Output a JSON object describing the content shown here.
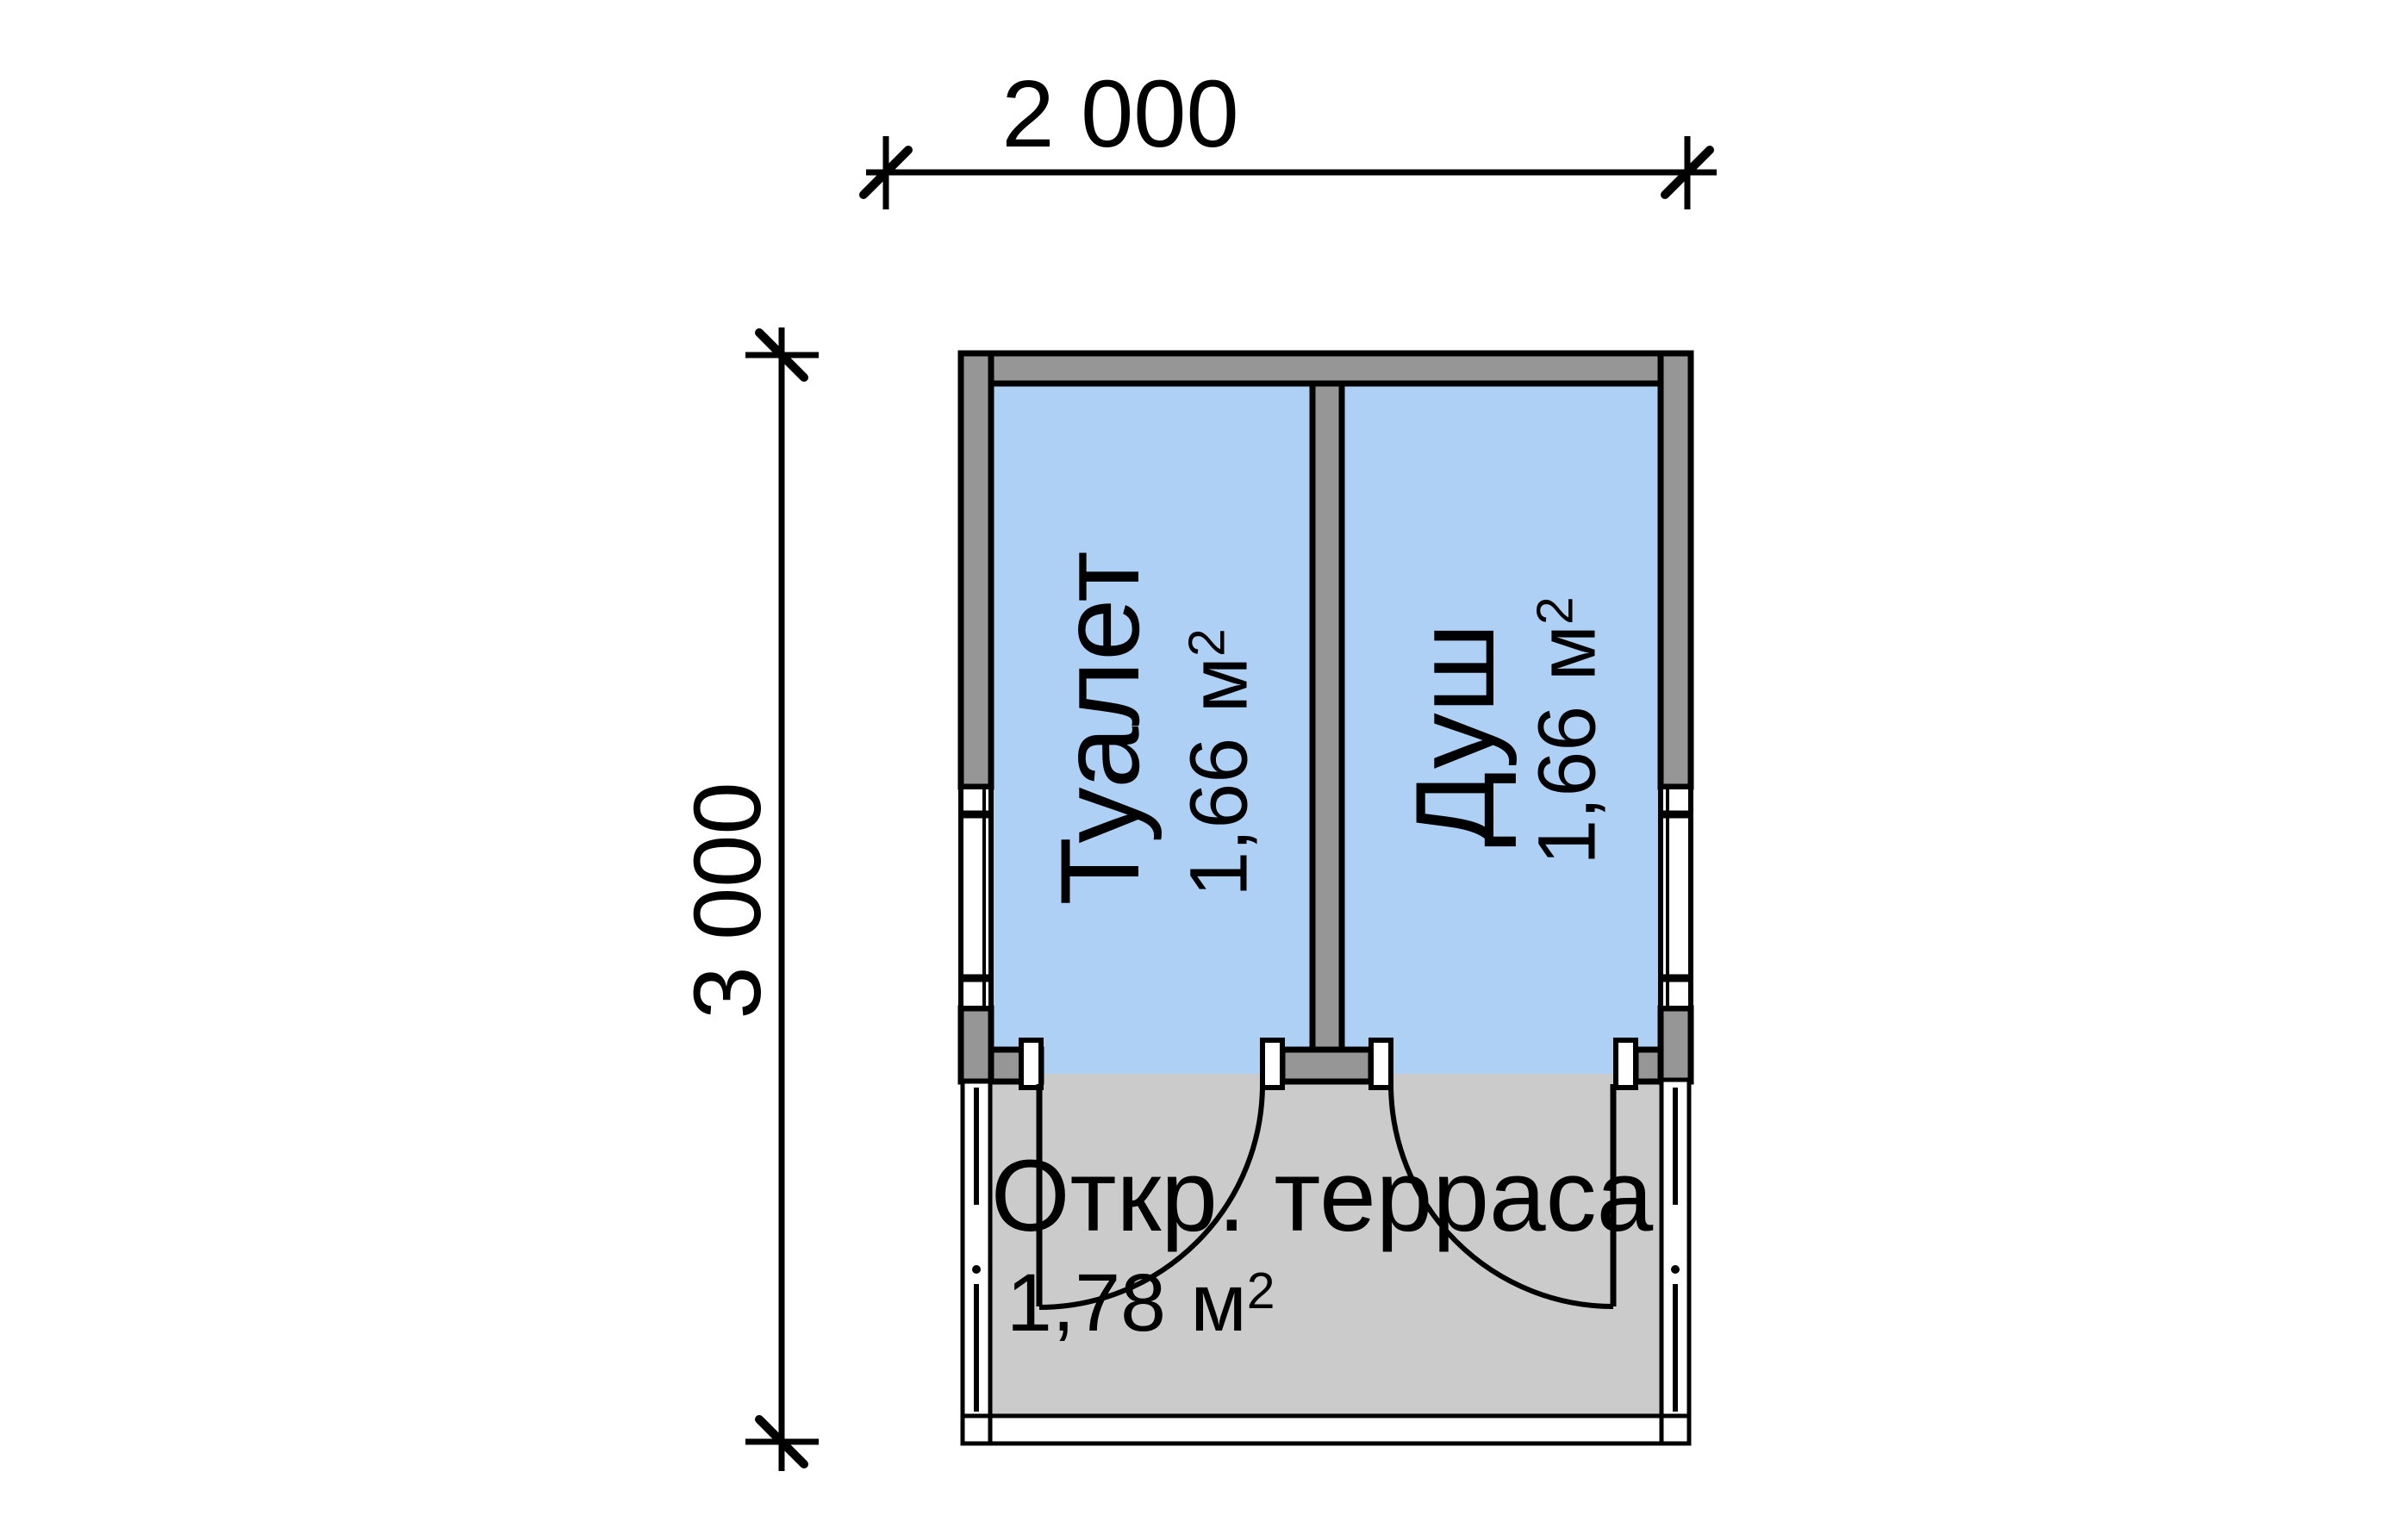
{
  "drawing": {
    "dimensions": {
      "width_label": "2 000",
      "height_label": "3 000"
    },
    "rooms": {
      "toilet": {
        "name": "Туалет",
        "area": "1,66",
        "unit": "м",
        "sup": "2"
      },
      "shower": {
        "name": "Душ",
        "area": "1,66",
        "unit": "м",
        "sup": "2"
      },
      "terrace": {
        "name": "Откр. терраса",
        "area": "1,78",
        "unit": "м",
        "sup": "2"
      }
    },
    "colors": {
      "room_floor": "#aed0f4",
      "terrace_floor": "#cbcbcb",
      "wall": "#969696",
      "line": "#000000",
      "frame_white": "#ffffff"
    }
  }
}
